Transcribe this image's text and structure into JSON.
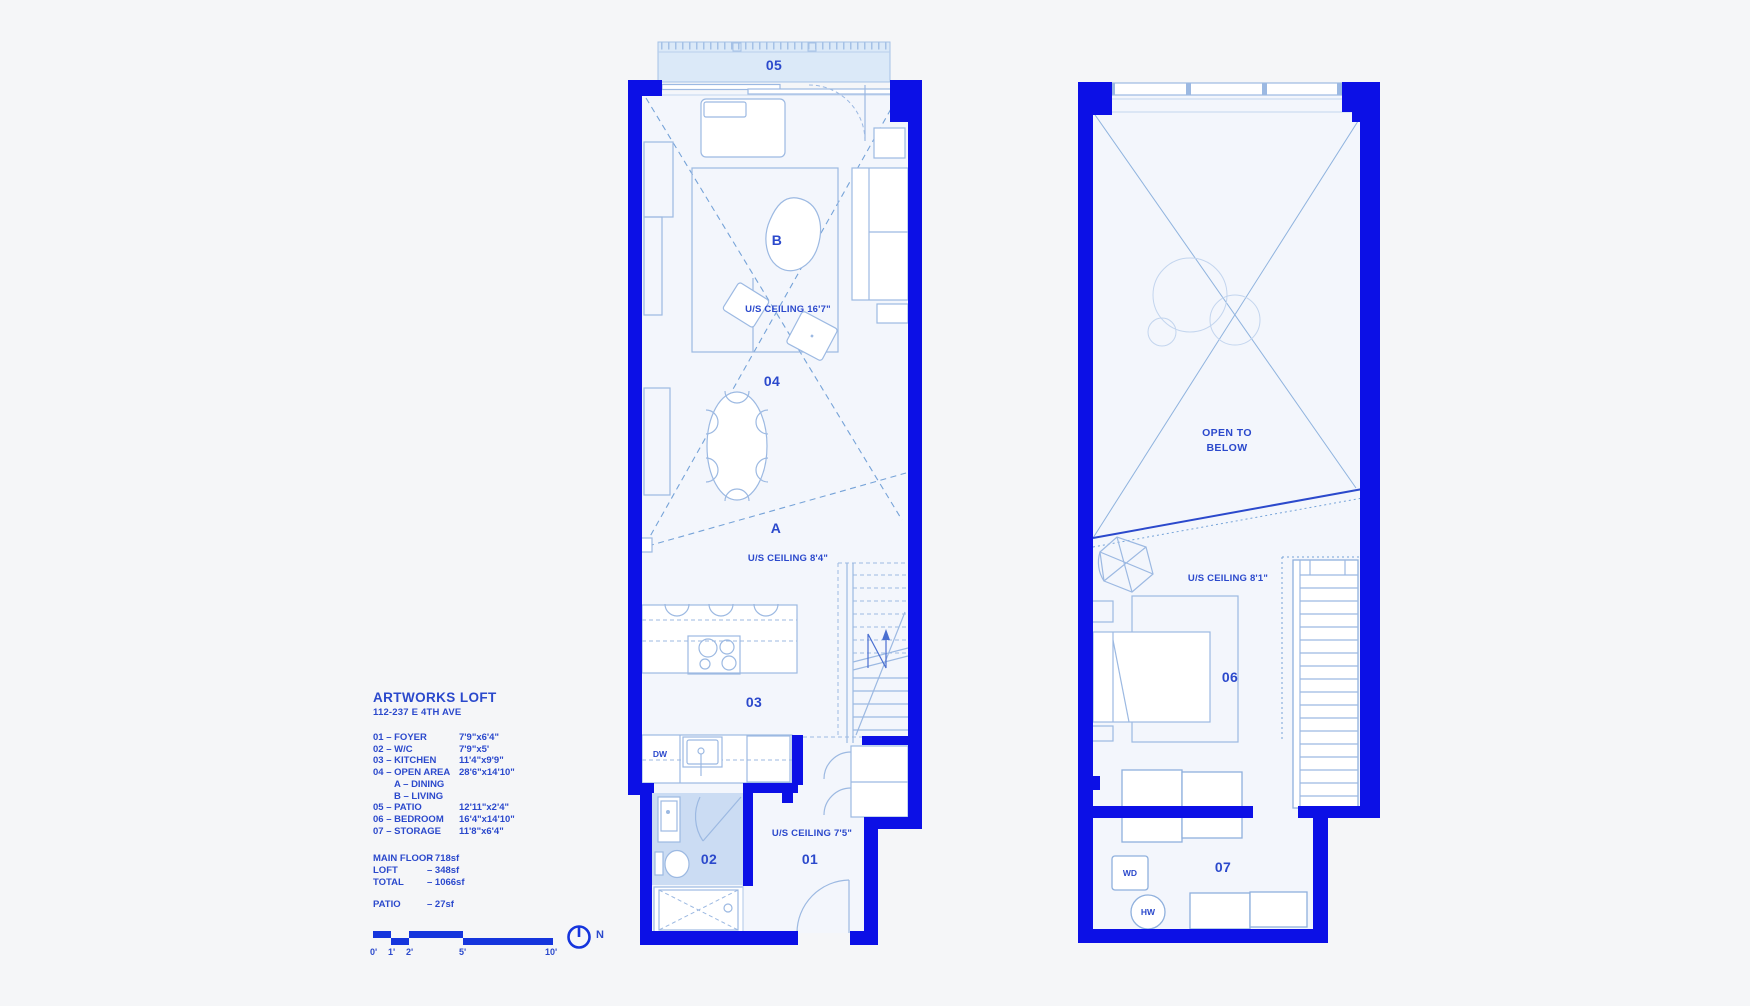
{
  "colors": {
    "wall_blue": "#0c10e6",
    "label_blue": "#2b49cc",
    "furniture_line": "#9cb9e2",
    "dash_line": "#76a3d8",
    "bath_fill": "#cbdcf3",
    "patio_fill": "#dbe9f8",
    "floor_fill": "#f3f6fc",
    "background": "#f5f6f8"
  },
  "legend": {
    "title": "ARTWORKS LOFT",
    "address": "112-237 E 4TH AVE",
    "rooms": [
      {
        "label": "01 – FOYER",
        "dims": "7'9\"x6'4\""
      },
      {
        "label": "02 – W/C",
        "dims": "7'9\"x5'"
      },
      {
        "label": "03 – KITCHEN",
        "dims": "11'4\"x9'9\""
      },
      {
        "label": "04 – OPEN AREA",
        "dims": "28'6\"x14'10\""
      },
      {
        "label": "A – DINING",
        "dims": ""
      },
      {
        "label": "B – LIVING",
        "dims": ""
      },
      {
        "label": "05 – PATIO",
        "dims": "12'11\"x2'4\""
      },
      {
        "label": "06 – BEDROOM",
        "dims": "16'4\"x14'10\""
      },
      {
        "label": "07 – STORAGE",
        "dims": "11'8\"x6'4\""
      }
    ],
    "areas": [
      {
        "label": "MAIN FLOOR",
        "value": "– 718sf"
      },
      {
        "label": "LOFT",
        "value": "– 348sf"
      },
      {
        "label": "TOTAL",
        "value": "– 1066sf"
      }
    ],
    "patio_area": {
      "label": "PATIO",
      "value": "– 27sf"
    },
    "scale_labels": [
      "0'",
      "1'",
      "2'",
      "5'",
      "10'"
    ],
    "north_label": "N"
  },
  "plan_main": {
    "patio_label": "05",
    "living_label": "B",
    "ceiling_living": "U/S CEILING 16'7\"",
    "open_label": "04",
    "dining_label": "A",
    "ceiling_dining": "U/S CEILING 8'4\"",
    "kitchen_label": "03",
    "dw_label": "DW",
    "wc_label": "02",
    "foyer_label": "01",
    "ceiling_foyer": "U/S CEILING 7'5\""
  },
  "plan_loft": {
    "open_line1": "OPEN TO",
    "open_line2": "BELOW",
    "ceiling": "U/S CEILING 8'1\"",
    "bedroom_label": "06",
    "storage_label": "07",
    "wd_label": "WD",
    "hw_label": "HW"
  }
}
